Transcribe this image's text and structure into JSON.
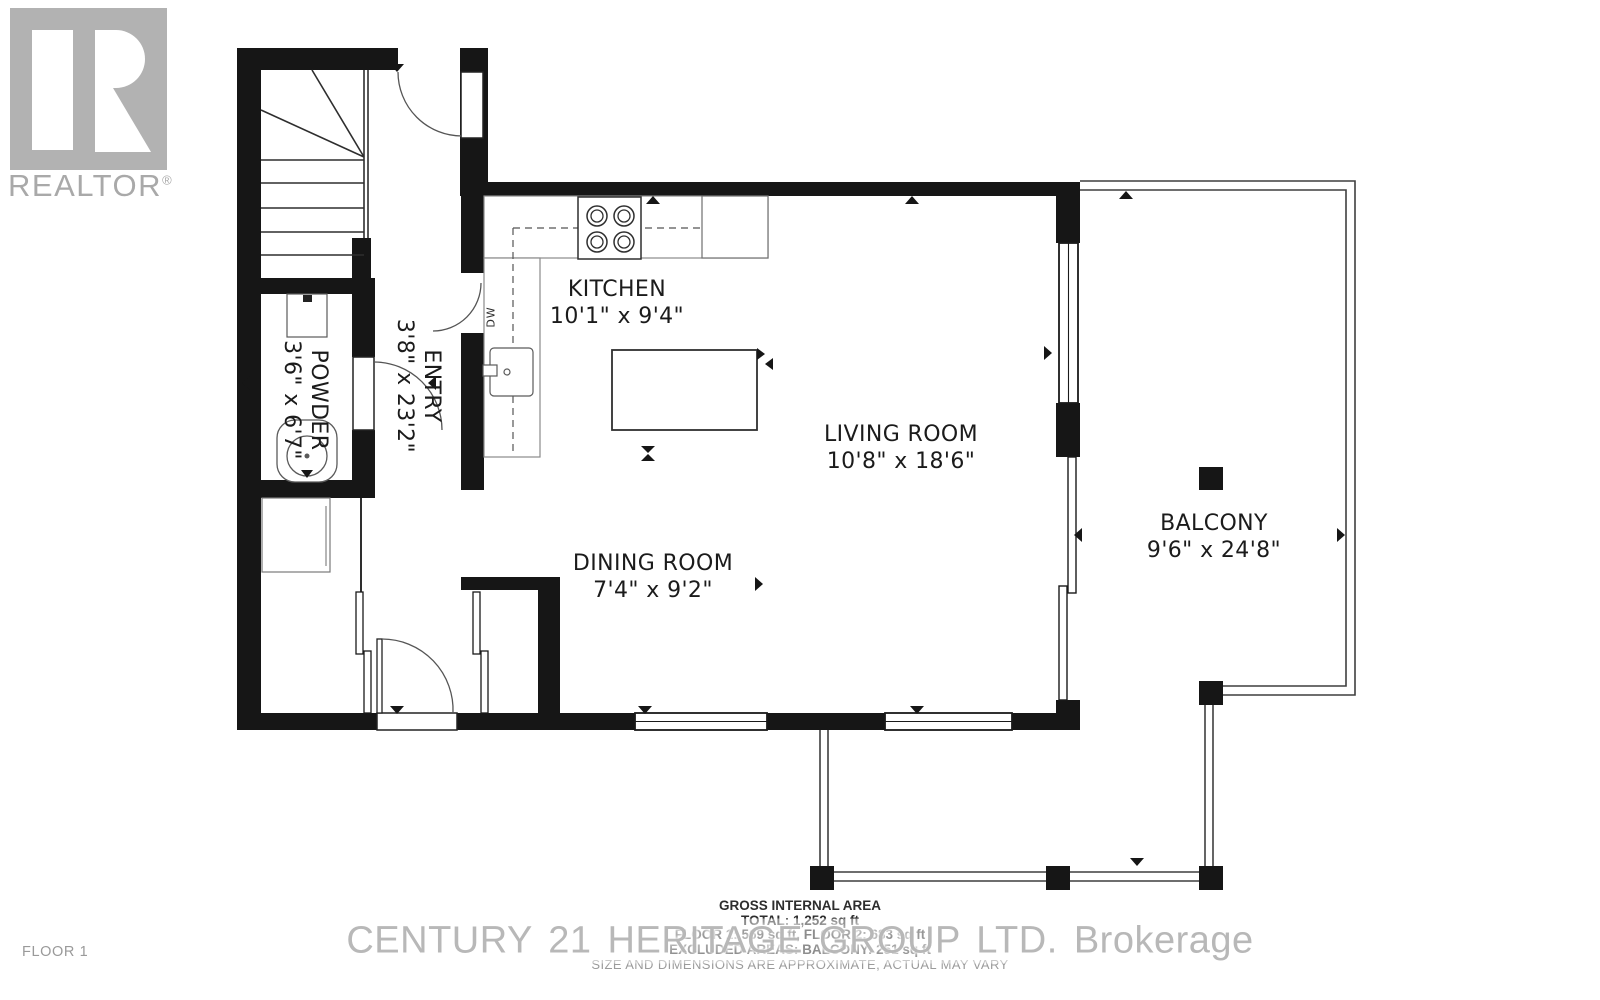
{
  "logo": {
    "brand": "REALTOR",
    "registered": "®"
  },
  "floor_label": "FLOOR 1",
  "rooms": {
    "kitchen": {
      "name": "KITCHEN",
      "dims": "10'1\" x 9'4\""
    },
    "living": {
      "name": "LIVING ROOM",
      "dims": "10'8\" x 18'6\""
    },
    "dining": {
      "name": "DINING ROOM",
      "dims": "7'4\" x 9'2\""
    },
    "entry": {
      "name": "ENTRY",
      "dims": "3'8\" x 23'2\""
    },
    "powder": {
      "name": "POWDER",
      "dims": "3'6\" x 6'7\""
    },
    "balcony": {
      "name": "BALCONY",
      "dims": "9'6\" x 24'8\""
    }
  },
  "appliances": {
    "dishwasher": "DW"
  },
  "area_summary": {
    "title": "GROSS INTERNAL AREA",
    "total": "TOTAL: 1,252 sq ft",
    "floors": "FLOOR 1: 569 sq ft, FLOOR 2: 683 sq ft",
    "excluded": "EXCLUDED AREAS: BALCONY: 251 sq ft",
    "disclaimer": "SIZE AND DIMENSIONS ARE APPROXIMATE, ACTUAL MAY VARY"
  },
  "watermark": "CENTURY 21 HERITAGE GROUP LTD. Brokerage",
  "colors": {
    "wall": "#161616",
    "thin_line": "#3f3f3f",
    "gray_text": "#9a9a9a",
    "logo_gray": "#b2b2b2"
  }
}
